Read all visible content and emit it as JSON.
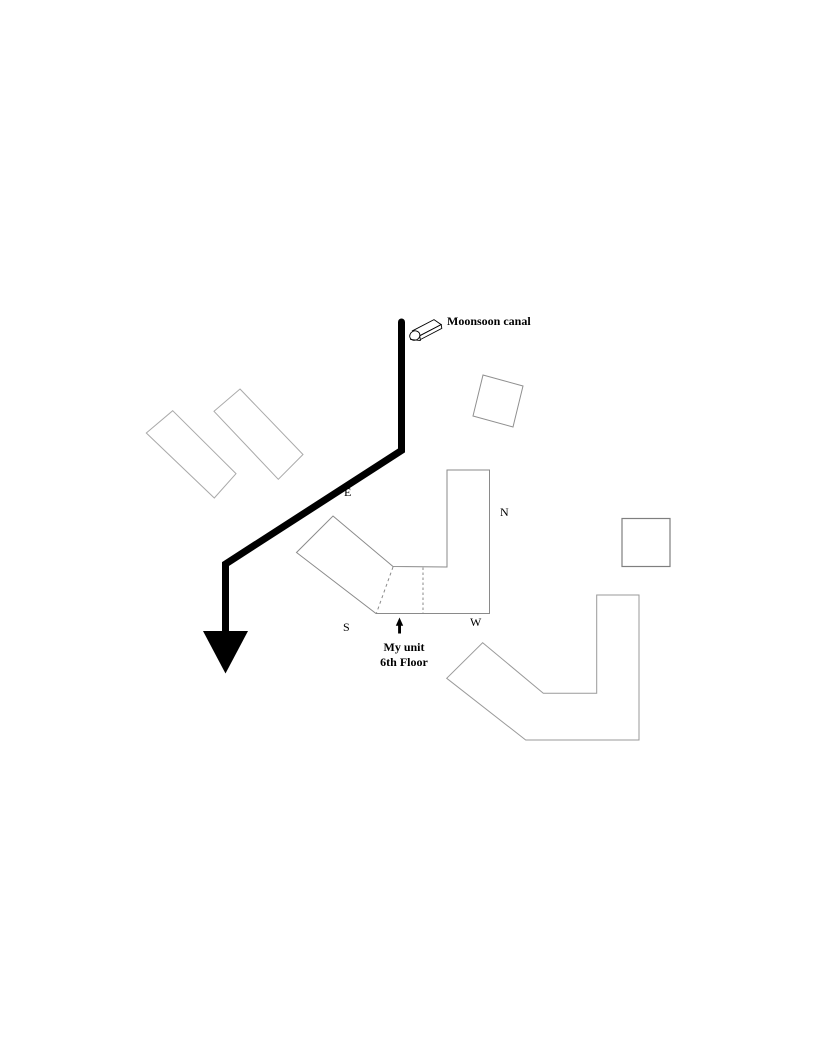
{
  "page": {
    "background": "#ffffff",
    "description_visible_text_only": true
  },
  "canal": {
    "label": "Moonsoon canal"
  },
  "compass": {
    "north": "N",
    "east": "E",
    "south": "S",
    "west": "W"
  },
  "unit": {
    "line1": "My unit",
    "line2": "6th Floor"
  },
  "colors": {
    "route_line": "#000000",
    "text": "#000000",
    "main_building_outline": "#8a8a8a",
    "chevron_building_outline": "#9a9a9a",
    "faint_building_outline": "#a9a9a9",
    "square_outline": "#7f7f7f",
    "tilted_square_outline": "#8f8f8f"
  },
  "icons": {
    "canal_marker": "canal-3d-marker-icon",
    "route_arrowhead": "route-arrowhead-icon",
    "unit_pointer": "unit-pointer-arrow-icon"
  }
}
